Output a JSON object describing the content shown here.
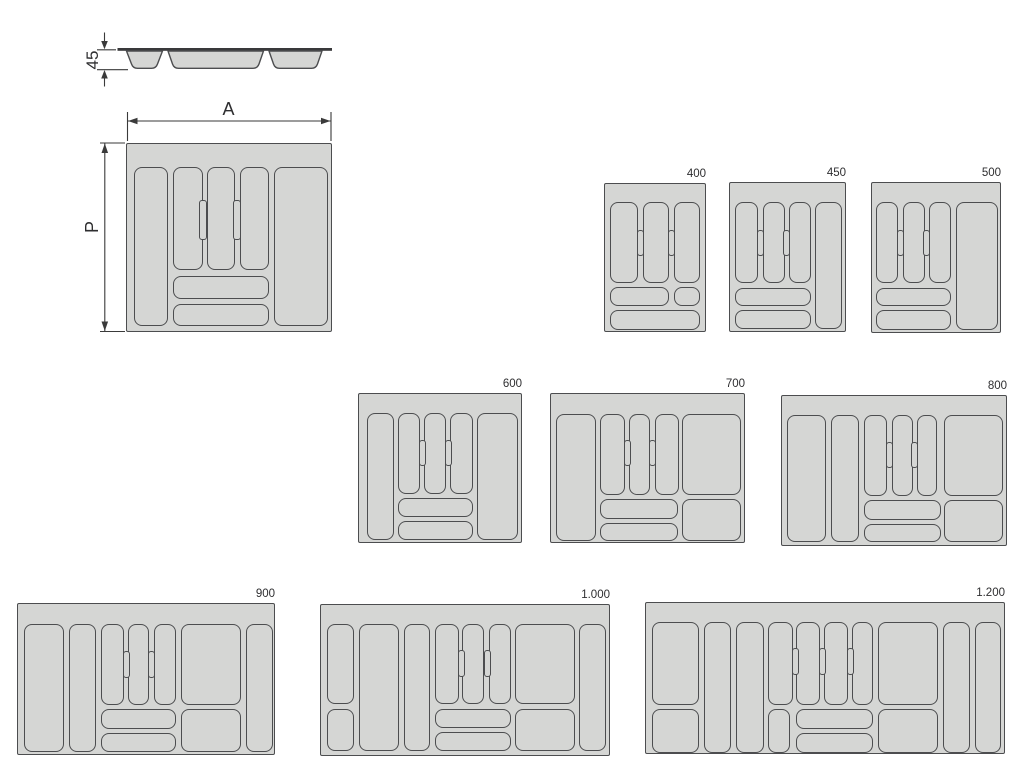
{
  "diagram": {
    "colors": {
      "background": "#ffffff",
      "tray_fill": "#d5d6d4",
      "outline": "#4c4d4f",
      "rim": "#39393b",
      "dim_line": "#3a3a3a",
      "text": "#2e2e30"
    },
    "dimensions": {
      "height_label": "45",
      "width_label": "A",
      "depth_label": "P"
    },
    "trays": [
      {
        "name": "main",
        "label": "",
        "x": 126,
        "y": 143,
        "w": 206,
        "h": 189,
        "compartments": [
          [
            7,
            23,
            34,
            159
          ],
          [
            46,
            23,
            30,
            103
          ],
          [
            80,
            23,
            28,
            103
          ],
          [
            113,
            23,
            29,
            103
          ],
          [
            147,
            23,
            54,
            159
          ],
          [
            46,
            132,
            96,
            23
          ],
          [
            46,
            160,
            96,
            22
          ]
        ],
        "notches": [
          [
            72,
            56,
            8,
            40
          ],
          [
            106,
            56,
            8,
            40
          ]
        ]
      },
      {
        "name": "400",
        "label": "400",
        "x": 604,
        "y": 183,
        "w": 102,
        "h": 149,
        "compartments": [
          [
            5,
            18,
            28,
            81
          ],
          [
            38,
            18,
            26,
            81
          ],
          [
            69,
            18,
            26,
            81
          ],
          [
            5,
            103,
            59,
            19
          ],
          [
            69,
            103,
            26,
            19
          ],
          [
            5,
            126,
            90,
            20
          ]
        ],
        "notches": [
          [
            32,
            46,
            7,
            26
          ],
          [
            63,
            46,
            7,
            26
          ]
        ]
      },
      {
        "name": "450",
        "label": "450",
        "x": 729,
        "y": 182,
        "w": 117,
        "h": 150,
        "compartments": [
          [
            5,
            19,
            23,
            81
          ],
          [
            33,
            19,
            22,
            81
          ],
          [
            59,
            19,
            22,
            81
          ],
          [
            85,
            19,
            27,
            127
          ],
          [
            5,
            105,
            76,
            18
          ],
          [
            5,
            127,
            76,
            19
          ]
        ],
        "notches": [
          [
            27,
            47,
            7,
            26
          ],
          [
            53,
            47,
            7,
            26
          ]
        ]
      },
      {
        "name": "500",
        "label": "500",
        "x": 871,
        "y": 182,
        "w": 130,
        "h": 151,
        "compartments": [
          [
            4,
            19,
            22,
            81
          ],
          [
            31,
            19,
            22,
            81
          ],
          [
            57,
            19,
            22,
            81
          ],
          [
            84,
            19,
            42,
            128
          ],
          [
            4,
            105,
            75,
            18
          ],
          [
            4,
            127,
            75,
            20
          ]
        ],
        "notches": [
          [
            25,
            47,
            7,
            26
          ],
          [
            51,
            47,
            7,
            26
          ]
        ]
      },
      {
        "name": "600",
        "label": "600",
        "x": 358,
        "y": 393,
        "w": 164,
        "h": 150,
        "compartments": [
          [
            8,
            19,
            27,
            127
          ],
          [
            39,
            19,
            22,
            81
          ],
          [
            65,
            19,
            22,
            81
          ],
          [
            91,
            19,
            23,
            81
          ],
          [
            118,
            19,
            41,
            127
          ],
          [
            39,
            104,
            75,
            19
          ],
          [
            39,
            127,
            75,
            19
          ]
        ],
        "notches": [
          [
            60,
            46,
            7,
            26
          ],
          [
            86,
            46,
            7,
            26
          ]
        ]
      },
      {
        "name": "700",
        "label": "700",
        "x": 550,
        "y": 393,
        "w": 195,
        "h": 150,
        "compartments": [
          [
            5,
            20,
            40,
            127
          ],
          [
            49,
            20,
            25,
            81
          ],
          [
            78,
            20,
            21,
            81
          ],
          [
            104,
            20,
            24,
            81
          ],
          [
            131,
            20,
            59,
            81
          ],
          [
            49,
            105,
            78,
            20
          ],
          [
            49,
            129,
            78,
            18
          ],
          [
            131,
            105,
            59,
            42
          ]
        ],
        "notches": [
          [
            73,
            46,
            7,
            26
          ],
          [
            98,
            46,
            7,
            26
          ]
        ]
      },
      {
        "name": "800",
        "label": "800",
        "x": 781,
        "y": 395,
        "w": 226,
        "h": 151,
        "compartments": [
          [
            5,
            19,
            39,
            127
          ],
          [
            49,
            19,
            28,
            127
          ],
          [
            82,
            19,
            23,
            81
          ],
          [
            110,
            19,
            21,
            81
          ],
          [
            135,
            19,
            20,
            81
          ],
          [
            162,
            19,
            59,
            81
          ],
          [
            82,
            104,
            77,
            20
          ],
          [
            82,
            128,
            77,
            18
          ],
          [
            162,
            104,
            59,
            42
          ]
        ],
        "notches": [
          [
            104,
            46,
            7,
            26
          ],
          [
            129,
            46,
            7,
            26
          ]
        ]
      },
      {
        "name": "900",
        "label": "900",
        "x": 17,
        "y": 603,
        "w": 258,
        "h": 152,
        "compartments": [
          [
            6,
            20,
            40,
            128
          ],
          [
            51,
            20,
            27,
            128
          ],
          [
            83,
            20,
            23,
            81
          ],
          [
            110,
            20,
            21,
            81
          ],
          [
            136,
            20,
            22,
            81
          ],
          [
            163,
            20,
            60,
            81
          ],
          [
            228,
            20,
            27,
            128
          ],
          [
            83,
            105,
            75,
            20
          ],
          [
            83,
            129,
            75,
            19
          ],
          [
            163,
            105,
            60,
            43
          ]
        ],
        "notches": [
          [
            105,
            47,
            7,
            27
          ],
          [
            130,
            47,
            7,
            27
          ]
        ]
      },
      {
        "name": "1000",
        "label": "1.000",
        "x": 320,
        "y": 604,
        "w": 290,
        "h": 152,
        "compartments": [
          [
            6,
            19,
            27,
            80
          ],
          [
            6,
            104,
            27,
            42
          ],
          [
            38,
            19,
            40,
            127
          ],
          [
            83,
            19,
            26,
            127
          ],
          [
            114,
            19,
            24,
            80
          ],
          [
            141,
            19,
            22,
            80
          ],
          [
            168,
            19,
            22,
            80
          ],
          [
            194,
            19,
            60,
            80
          ],
          [
            258,
            19,
            27,
            127
          ],
          [
            114,
            104,
            76,
            19
          ],
          [
            114,
            127,
            76,
            19
          ],
          [
            194,
            104,
            60,
            42
          ]
        ],
        "notches": [
          [
            137,
            45,
            7,
            27
          ],
          [
            163,
            45,
            7,
            27
          ]
        ]
      },
      {
        "name": "1200",
        "label": "1.200",
        "x": 645,
        "y": 602,
        "w": 360,
        "h": 152,
        "compartments": [
          [
            6,
            19,
            47,
            83
          ],
          [
            6,
            106,
            47,
            44
          ],
          [
            58,
            19,
            27,
            131
          ],
          [
            90,
            19,
            28,
            131
          ],
          [
            122,
            19,
            25,
            83
          ],
          [
            122,
            106,
            22,
            44
          ],
          [
            150,
            19,
            24,
            83
          ],
          [
            178,
            19,
            24,
            83
          ],
          [
            206,
            19,
            21,
            83
          ],
          [
            232,
            19,
            60,
            83
          ],
          [
            232,
            106,
            60,
            44
          ],
          [
            297,
            19,
            27,
            131
          ],
          [
            329,
            19,
            26,
            131
          ],
          [
            150,
            106,
            77,
            20
          ],
          [
            150,
            130,
            77,
            20
          ]
        ],
        "notches": [
          [
            146,
            45,
            7,
            27
          ],
          [
            173,
            45,
            7,
            27
          ],
          [
            201,
            45,
            7,
            27
          ]
        ]
      }
    ]
  }
}
